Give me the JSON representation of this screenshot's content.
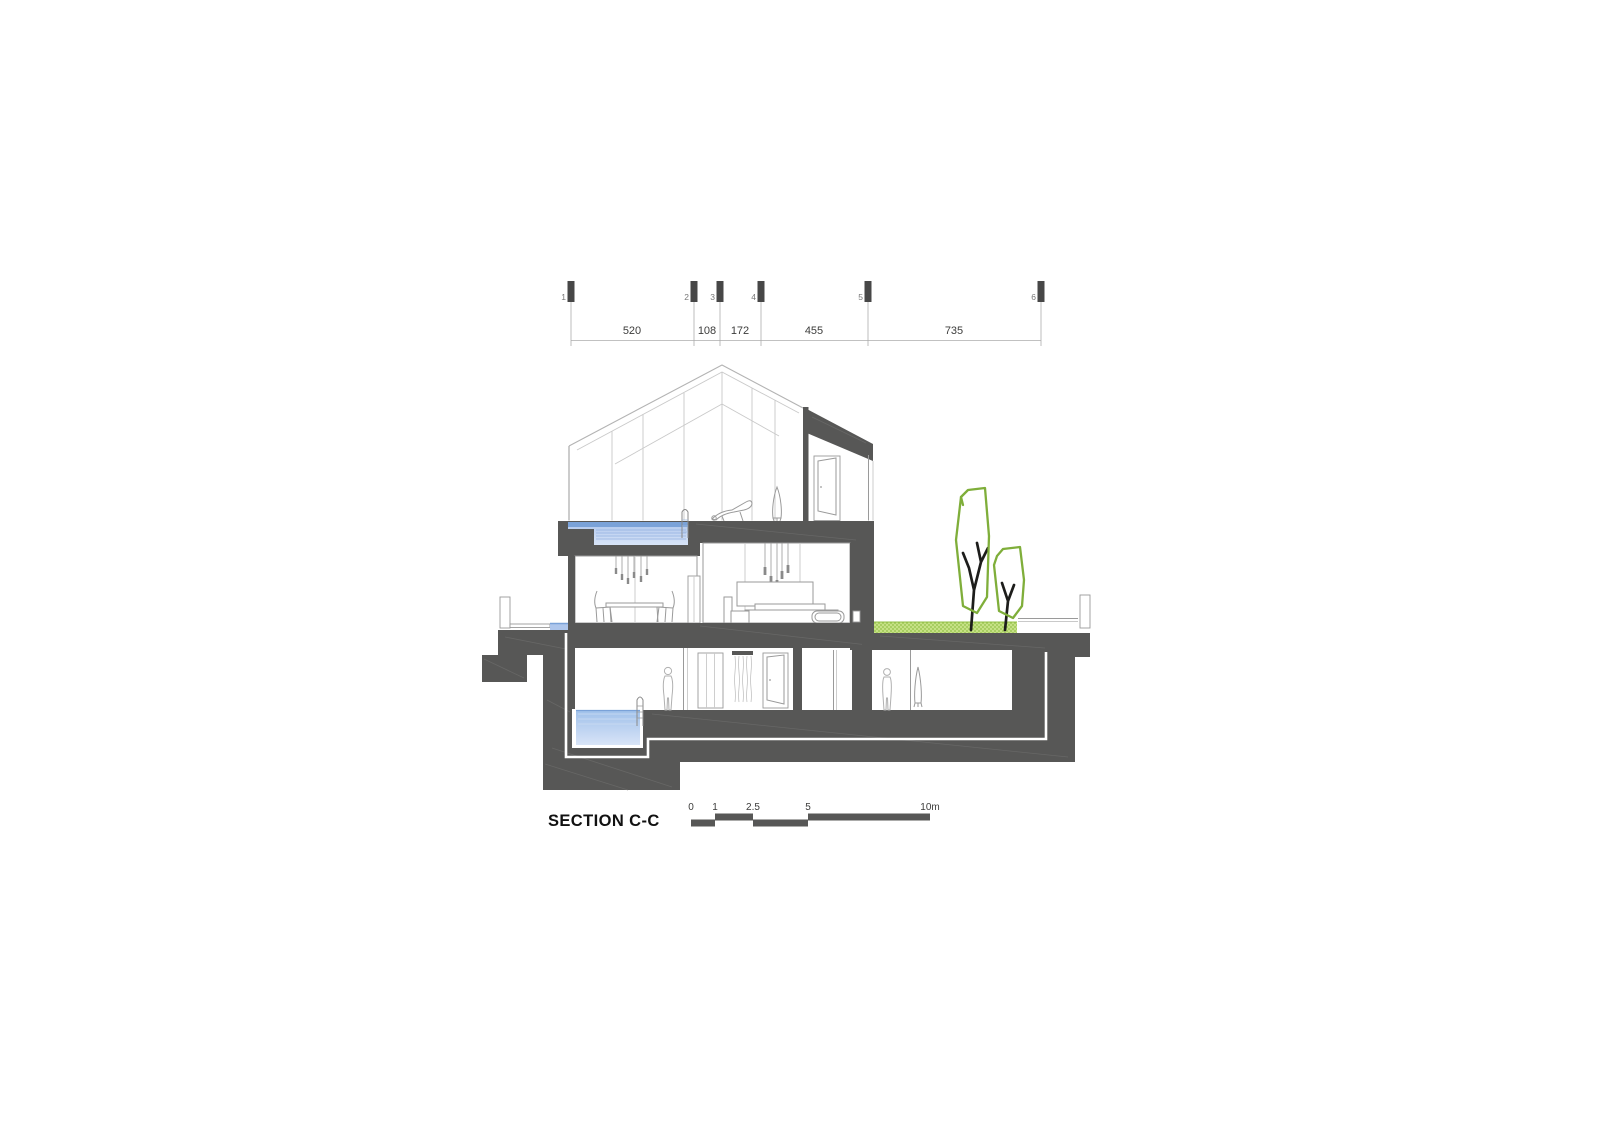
{
  "title": "SECTION C-C",
  "dimension_strip": {
    "grid_markers": [
      "1",
      "2",
      "3",
      "4",
      "5",
      "6"
    ],
    "dimensions": [
      "520",
      "108",
      "172",
      "455",
      "735"
    ]
  },
  "scale_bar": {
    "labels": [
      "0",
      "1",
      "2.5",
      "5",
      "10m"
    ]
  },
  "colors": {
    "structure_dark": "#575756",
    "marker_dark": "#474747",
    "pool_surface": "#7aa2d8",
    "pool_water": "#aec6ec",
    "pool_water_light": "#d8e4f7",
    "grass_light": "#c6e185",
    "grass_dot": "#93c047",
    "tree_green": "#7fae3a",
    "trunk_black": "#1d1d1b",
    "line_gray": "#b3b3b3",
    "text_dark": "#3c3c3b"
  }
}
